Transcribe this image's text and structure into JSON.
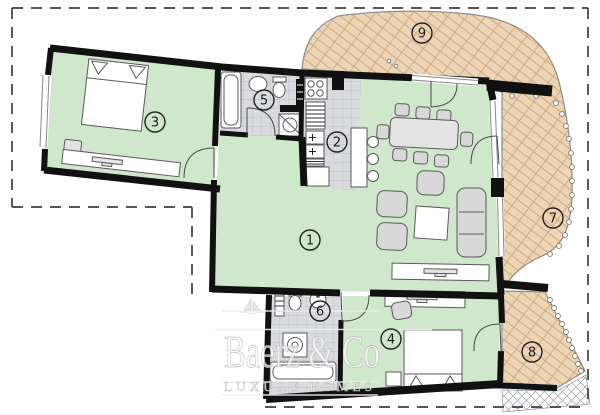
{
  "plan": {
    "type": "apartment-floor-plan",
    "rooms": [
      {
        "number": "1"
      },
      {
        "number": "2"
      },
      {
        "number": "3"
      },
      {
        "number": "4"
      },
      {
        "number": "5"
      },
      {
        "number": "6"
      },
      {
        "number": "7"
      },
      {
        "number": "8"
      },
      {
        "number": "9"
      }
    ]
  },
  "watermark": {
    "brand": "Baerz & Co",
    "tagline": "LUXURY HOMES"
  },
  "colors": {
    "room_fill": "#cfe7ca",
    "terrace_fill": "#ecd4b6",
    "tile_fill": "#d9dbdf",
    "wall": "#111111",
    "boundary_dash": "#3f3f3f",
    "watermark_gray": "#c9c9c9"
  }
}
